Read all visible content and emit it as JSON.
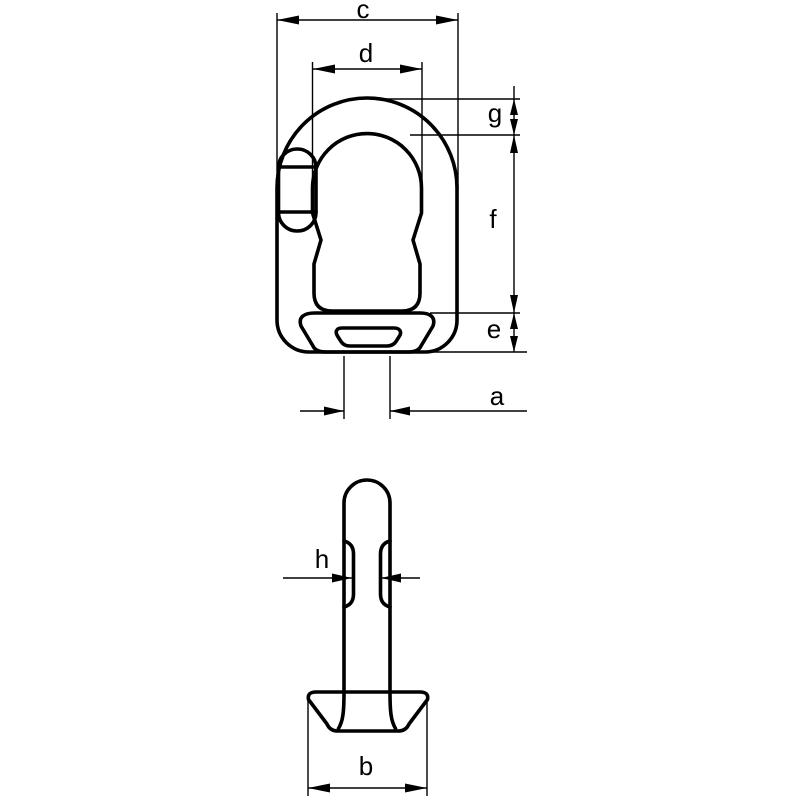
{
  "labels": {
    "a": "a",
    "b": "b",
    "c": "c",
    "d": "d",
    "e": "e",
    "f": "f",
    "g": "g",
    "h": "h"
  },
  "colors": {
    "line": "#000000",
    "background": "#ffffff"
  }
}
